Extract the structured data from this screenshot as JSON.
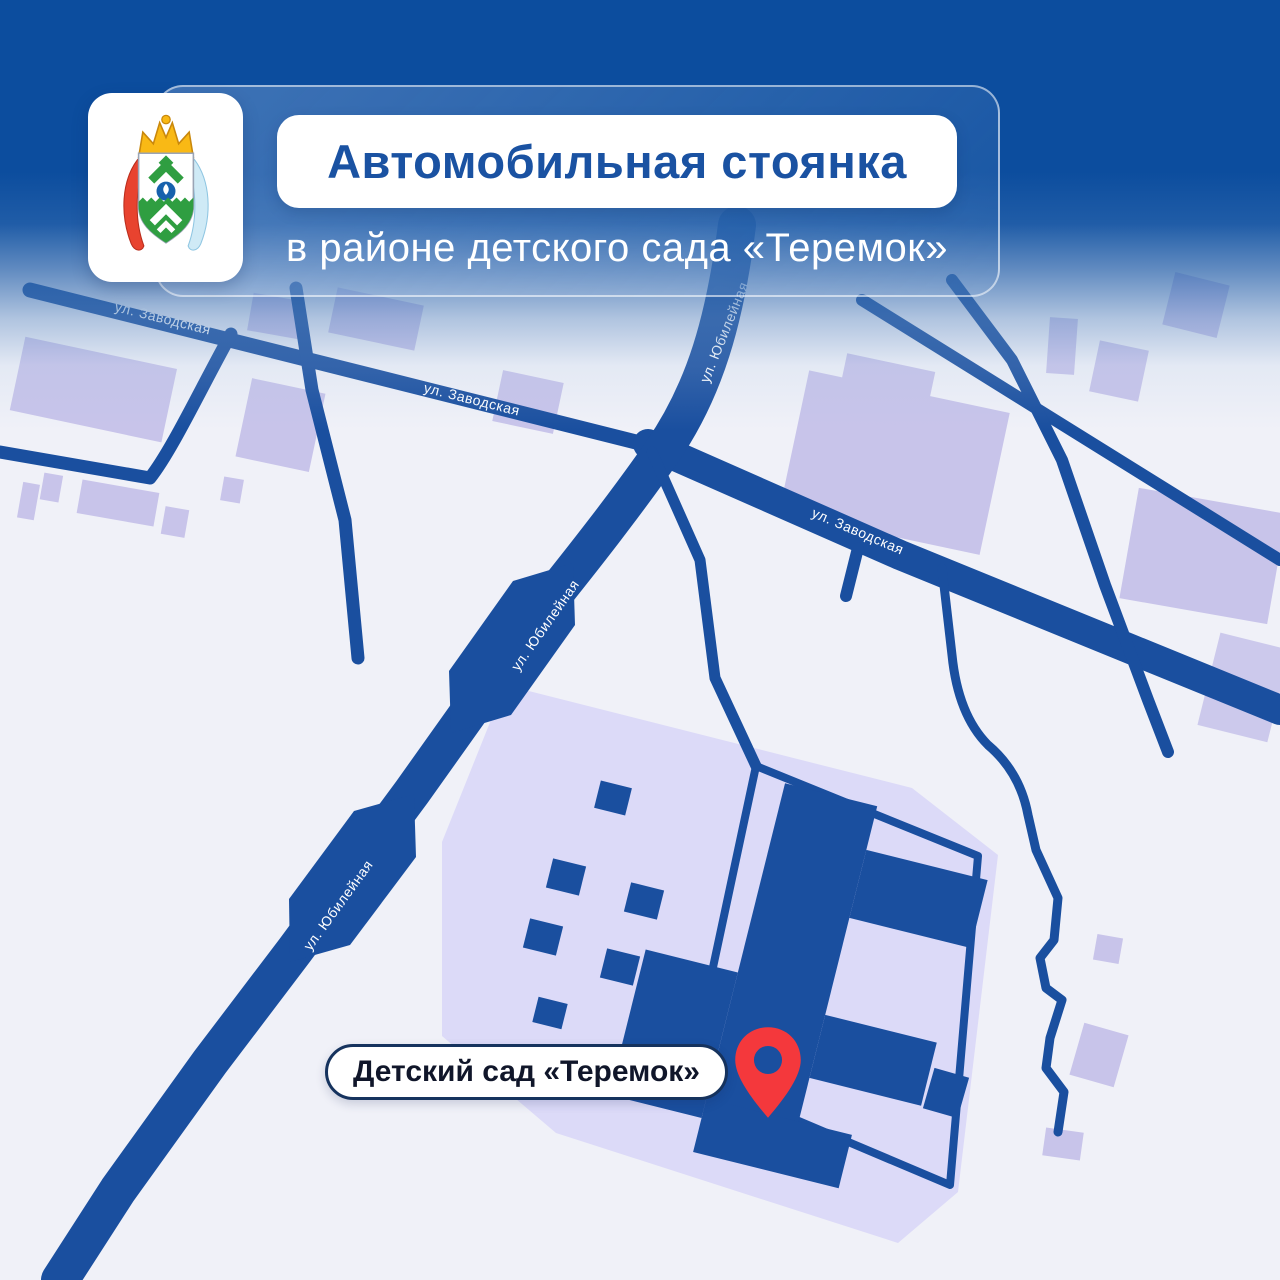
{
  "header": {
    "title": "Автомобильная стоянка",
    "subtitle": "в районе детского сада «Теремок»",
    "logo_icon": "coat-of-arms-nenets-okrug"
  },
  "streets": {
    "zavodskaya": "ул. Заводская",
    "yubileynaya": "ул. Юбилейная"
  },
  "street_labels": [
    "ул. Заводская",
    "ул. Заводская",
    "ул. Заводская",
    "ул. Юбилейная",
    "ул. Юбилейная",
    "ул. Юбилейная"
  ],
  "poi": {
    "label": "Детский сад «Теремок»",
    "marker_icon": "location-pin"
  },
  "colors": {
    "header_blue": "#0c4d9e",
    "road_navy": "#1a4f9f",
    "building_lavender": "#c8c4ea",
    "parcel_lavender": "#dcdaf8",
    "pin_red": "#f4383c",
    "title_text": "#1a52a2",
    "poi_text": "#10162a",
    "street_label_text": "#ffffff"
  }
}
